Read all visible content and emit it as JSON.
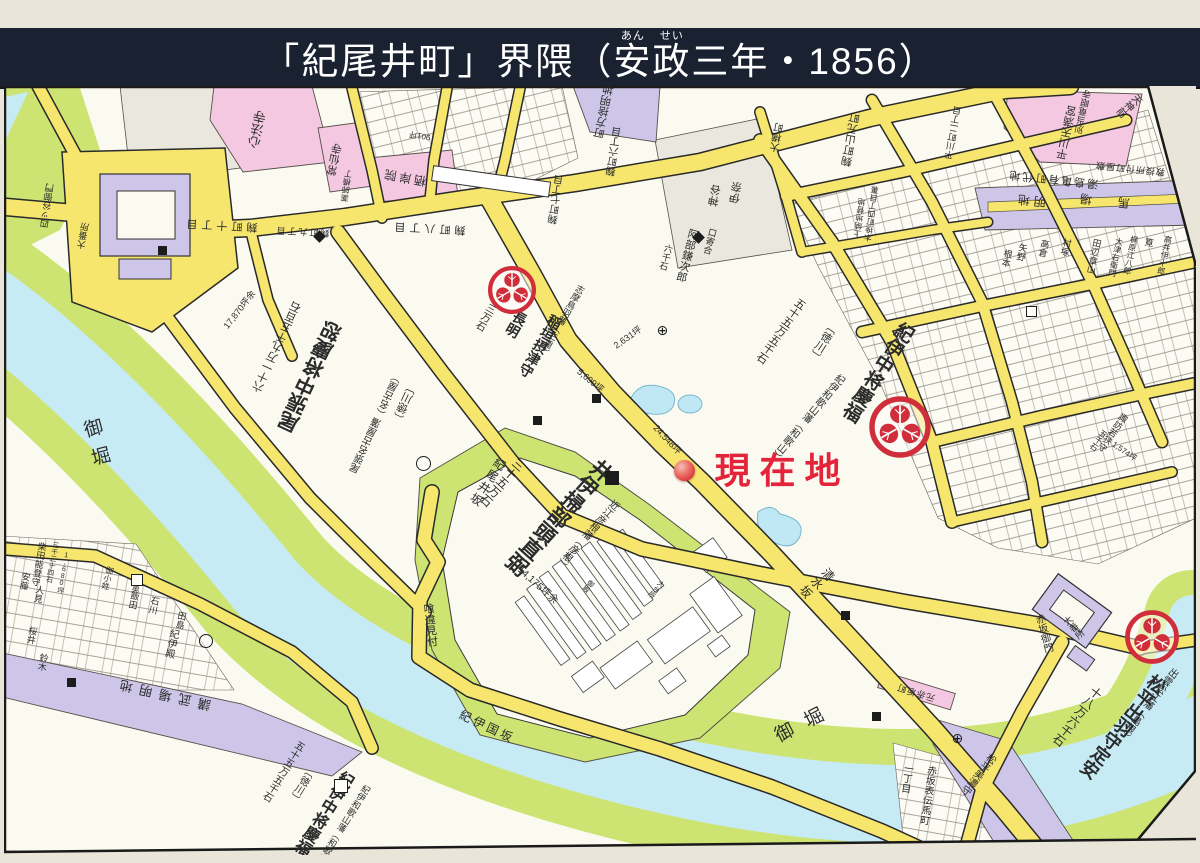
{
  "header": {
    "title_pre": "「紀尾井町」界隈（",
    "ruby": [
      {
        "base": "安",
        "rt": "あん"
      },
      {
        "base": "政",
        "rt": "せい"
      }
    ],
    "title_post": "三年・1856）"
  },
  "colors": {
    "header_bg": "#1a2130",
    "road_fill": "#f6e66e",
    "road_edge": "#2a2a2a",
    "water": "#c6ebf5",
    "bank_green": "#cde473",
    "temple_pink": "#f4c8e1",
    "open_purple": "#cdc6e9",
    "crest_red": "#cf2e3a",
    "marker_red": "#e3243b"
  },
  "map": {
    "current_location": {
      "label": "現在地",
      "dot_x": 684,
      "dot_y": 470
    },
    "labels": [
      {
        "t": "御堀",
        "x": 96,
        "y": 447,
        "s": 19,
        "v": 1,
        "r": -15,
        "ls": 10
      },
      {
        "t": "御堀",
        "x": 806,
        "y": 723,
        "s": 19,
        "r": -27,
        "ls": 14
      },
      {
        "t": "現在地",
        "x": 782,
        "y": 471,
        "s": 36,
        "w": 700,
        "c": "#e3243b",
        "ls": 9
      },
      {
        "t": "井伊掃部頭直弼",
        "x": 558,
        "y": 516,
        "s": 21,
        "v": 1,
        "r": 42,
        "w": 600
      },
      {
        "t": "近江彦根藩（彦根）",
        "x": 586,
        "y": 533,
        "s": 10,
        "v": 1,
        "r": 42
      },
      {
        "t": "三十五万石",
        "x": 502,
        "y": 482,
        "s": 12,
        "v": 1,
        "r": 42
      },
      {
        "t": "14,175坪余",
        "x": 537,
        "y": 586,
        "s": 10,
        "r": 42
      },
      {
        "t": "紀尾井坂",
        "x": 487,
        "y": 482,
        "s": 12,
        "v": 1,
        "r": 33,
        "ls": 2
      },
      {
        "t": "清水坂",
        "x": 816,
        "y": 583,
        "s": 12,
        "v": 1,
        "r": 52,
        "ls": 2
      },
      {
        "t": "喰違見付",
        "x": 429,
        "y": 625,
        "s": 11,
        "v": 1,
        "r": -6
      },
      {
        "t": "紀伊国坂",
        "x": 487,
        "y": 727,
        "s": 12,
        "r": 25,
        "ls": 3
      },
      {
        "t": "紀伊中将慶福",
        "x": 877,
        "y": 371,
        "s": 19,
        "v": 1,
        "r": 33,
        "w": 600
      },
      {
        "t": "紀伊和歌山藩（和歌山）",
        "x": 806,
        "y": 416,
        "s": 10,
        "v": 1,
        "r": 40
      },
      {
        "t": "〔徳川〕",
        "x": 822,
        "y": 341,
        "s": 11,
        "v": 1,
        "r": 33
      },
      {
        "t": "五十五万五千石",
        "x": 780,
        "y": 330,
        "s": 11,
        "v": 1,
        "r": 35
      },
      {
        "t": "尾張中将慶恕",
        "x": 312,
        "y": 378,
        "s": 20,
        "v": 1,
        "r": 205,
        "w": 600
      },
      {
        "t": "尾張名古屋藩（名古屋）",
        "x": 378,
        "y": 424,
        "s": 10,
        "v": 1,
        "r": 205
      },
      {
        "t": "〔徳川〕",
        "x": 406,
        "y": 404,
        "s": 11,
        "v": 1,
        "r": 205
      },
      {
        "t": "六十一万九千五百石",
        "x": 278,
        "y": 348,
        "s": 11,
        "v": 1,
        "r": 205
      },
      {
        "t": "17,870坪余",
        "x": 240,
        "y": 310,
        "s": 9,
        "r": -52
      },
      {
        "t": "稲垣摂津守",
        "x": 540,
        "y": 346,
        "s": 14,
        "v": 1,
        "r": 30,
        "w": 600
      },
      {
        "t": "長明",
        "x": 516,
        "y": 324,
        "s": 14,
        "v": 1,
        "r": 30,
        "w": 600
      },
      {
        "t": "志摩鳥羽藩（三重）",
        "x": 561,
        "y": 320,
        "s": 9,
        "v": 1,
        "r": 30
      },
      {
        "t": "三万石",
        "x": 484,
        "y": 316,
        "s": 10,
        "v": 1,
        "r": 30
      },
      {
        "t": "5,699坪",
        "x": 590,
        "y": 381,
        "s": 9,
        "r": 40
      },
      {
        "t": "2,631坪",
        "x": 628,
        "y": 338,
        "s": 9,
        "r": -35
      },
      {
        "t": "24,548坪",
        "x": 667,
        "y": 440,
        "s": 9,
        "r": 47
      },
      {
        "t": "口寄合",
        "x": 709,
        "y": 241,
        "s": 9,
        "v": 1,
        "r": 15
      },
      {
        "t": "阿部鎌次郎",
        "x": 686,
        "y": 255,
        "s": 11,
        "v": 1,
        "r": 15
      },
      {
        "t": "六千石",
        "x": 665,
        "y": 257,
        "s": 9,
        "v": 1,
        "r": 15
      },
      {
        "t": "松平出羽守定安",
        "x": 1122,
        "y": 726,
        "s": 18,
        "v": 1,
        "r": 38,
        "w": 600
      },
      {
        "t": "出雲松江藩（島根）",
        "x": 1147,
        "y": 703,
        "s": 10,
        "v": 1,
        "r": 38
      },
      {
        "t": "十八万六千石",
        "x": 1077,
        "y": 716,
        "s": 12,
        "v": 1,
        "r": 38
      },
      {
        "t": "赤坂御門",
        "x": 1042,
        "y": 634,
        "s": 10,
        "v": 1,
        "r": -15
      },
      {
        "t": "大番所",
        "x": 1073,
        "y": 628,
        "s": 9,
        "v": 1,
        "r": -40
      },
      {
        "t": "四ッ谷御門",
        "x": 48,
        "y": 206,
        "s": 9,
        "v": 1,
        "r": 188
      },
      {
        "t": "大番所",
        "x": 84,
        "y": 236,
        "s": 9,
        "v": 1,
        "r": 190
      },
      {
        "t": "講武場明地",
        "x": 162,
        "y": 694,
        "s": 13,
        "r": 193,
        "ls": 7
      },
      {
        "t": "紀伊殿",
        "x": 170,
        "y": 643,
        "s": 10,
        "v": 1,
        "r": 12
      },
      {
        "t": "石川",
        "x": 153,
        "y": 605,
        "s": 9,
        "v": 1,
        "r": 12
      },
      {
        "t": "飯田",
        "x": 133,
        "y": 600,
        "s": 9,
        "v": 1,
        "r": 12
      },
      {
        "t": "田島",
        "x": 180,
        "y": 620,
        "s": 9,
        "v": 1,
        "r": 12
      },
      {
        "t": "柴田能登守",
        "x": 38,
        "y": 564,
        "s": 9,
        "v": 1,
        "r": 10
      },
      {
        "t": "三千三十四石",
        "x": 52,
        "y": 562,
        "s": 7,
        "v": 1,
        "r": 10
      },
      {
        "t": "1,680坪",
        "x": 63,
        "y": 573,
        "s": 7,
        "v": 1,
        "r": 10
      },
      {
        "t": "安藤",
        "x": 24,
        "y": 581,
        "s": 9,
        "v": 1,
        "r": 10
      },
      {
        "t": "人見",
        "x": 38,
        "y": 594,
        "s": 9,
        "v": 1,
        "r": 10
      },
      {
        "t": "御小姓",
        "x": 107,
        "y": 578,
        "s": 8,
        "v": 1,
        "r": 14
      },
      {
        "t": "中奥",
        "x": 136,
        "y": 585,
        "s": 8,
        "v": 1,
        "r": 14
      },
      {
        "t": "桜井",
        "x": 31,
        "y": 635,
        "s": 9,
        "v": 1,
        "r": 10
      },
      {
        "t": "鈴木",
        "x": 42,
        "y": 662,
        "s": 9,
        "v": 1,
        "r": 10
      },
      {
        "t": "心法寺",
        "x": 258,
        "y": 130,
        "s": 13,
        "v": 1,
        "r": 192
      },
      {
        "t": "常仙寺",
        "x": 336,
        "y": 160,
        "s": 11,
        "v": 1,
        "r": 192
      },
      {
        "t": "栖岸院",
        "x": 404,
        "y": 177,
        "s": 12,
        "r": 190,
        "ls": 3
      },
      {
        "t": "薬師横丁",
        "x": 347,
        "y": 186,
        "s": 8,
        "v": 1,
        "r": 188
      },
      {
        "t": "麹町十丁目",
        "x": 220,
        "y": 224,
        "s": 11,
        "r": 183,
        "ls": 4
      },
      {
        "t": "麹町九丁目",
        "x": 302,
        "y": 231,
        "s": 9,
        "r": 183,
        "ls": 2
      },
      {
        "t": "麹町八丁目",
        "x": 428,
        "y": 227,
        "s": 11,
        "r": 183,
        "ls": 4
      },
      {
        "t": "麹町七丁目",
        "x": 558,
        "y": 200,
        "s": 10,
        "v": 1,
        "r": 188
      },
      {
        "t": "麹町六丁目",
        "x": 616,
        "y": 152,
        "s": 10,
        "v": 1,
        "r": 188
      },
      {
        "t": "大横町",
        "x": 779,
        "y": 138,
        "s": 10,
        "v": 1,
        "r": 190
      },
      {
        "t": "麹町山元町",
        "x": 852,
        "y": 140,
        "s": 11,
        "v": 1,
        "r": 190
      },
      {
        "t": "平川町二丁目",
        "x": 954,
        "y": 133,
        "s": 9,
        "v": 1,
        "r": 190
      },
      {
        "t": "木挽町四丁目裏",
        "x": 872,
        "y": 214,
        "s": 8,
        "v": 1,
        "r": 188
      },
      {
        "t": "上納地替地",
        "x": 860,
        "y": 218,
        "s": 8,
        "v": 1,
        "r": 188
      },
      {
        "t": "天神前",
        "x": 1128,
        "y": 104,
        "s": 10,
        "v": 1,
        "r": 50
      },
      {
        "t": "平川天満宮",
        "x": 1068,
        "y": 133,
        "s": 11,
        "v": 1,
        "r": 192
      },
      {
        "t": "別当竜眼寺",
        "x": 1084,
        "y": 112,
        "s": 9,
        "v": 1,
        "r": 192
      },
      {
        "t": "湯島亀有町代地",
        "x": 1053,
        "y": 178,
        "s": 11,
        "r": 186,
        "ls": 2
      },
      {
        "t": "教授所付町屋敷",
        "x": 1130,
        "y": 168,
        "s": 9,
        "r": 186,
        "ls": 1
      },
      {
        "t": "明地",
        "x": 1030,
        "y": 200,
        "s": 12,
        "r": 186,
        "ls": 4
      },
      {
        "t": "馬場",
        "x": 1092,
        "y": 199,
        "s": 12,
        "r": 186,
        "ls": 26
      },
      {
        "t": "町方捨明地",
        "x": 605,
        "y": 112,
        "s": 11,
        "v": 1,
        "r": 192
      },
      {
        "t": "神谷",
        "x": 716,
        "y": 196,
        "s": 11,
        "v": 1,
        "r": 190
      },
      {
        "t": "伊奈",
        "x": 737,
        "y": 193,
        "s": 11,
        "v": 1,
        "r": 190
      },
      {
        "t": "根本",
        "x": 1006,
        "y": 258,
        "s": 9,
        "v": 1,
        "r": 12
      },
      {
        "t": "矢野",
        "x": 1021,
        "y": 252,
        "s": 9,
        "v": 1,
        "r": 12
      },
      {
        "t": "高倉",
        "x": 1043,
        "y": 248,
        "s": 9,
        "v": 1,
        "r": 12
      },
      {
        "t": "村塚",
        "x": 1065,
        "y": 247,
        "s": 9,
        "v": 1,
        "r": 12
      },
      {
        "t": "田辺章山",
        "x": 1093,
        "y": 256,
        "s": 9,
        "v": 1,
        "r": 12
      },
      {
        "t": "大津右衛門",
        "x": 1115,
        "y": 257,
        "s": 8,
        "v": 1,
        "r": 12
      },
      {
        "t": "梶原江八郎",
        "x": 1130,
        "y": 255,
        "s": 8,
        "v": 1,
        "r": 12
      },
      {
        "t": "筧",
        "x": 1148,
        "y": 242,
        "s": 9,
        "v": 1,
        "r": 12
      },
      {
        "t": "高井伊十郎",
        "x": 1164,
        "y": 255,
        "s": 8,
        "v": 1,
        "r": 12
      },
      {
        "t": "諏訪若狭守",
        "x": 1112,
        "y": 432,
        "s": 9,
        "v": 1,
        "r": 35
      },
      {
        "t": "五千石",
        "x": 1098,
        "y": 440,
        "s": 8,
        "v": 1,
        "r": 35
      },
      {
        "t": "1,574坪",
        "x": 1124,
        "y": 452,
        "s": 8,
        "r": 35
      },
      {
        "t": "赤坂表伝馬町",
        "x": 926,
        "y": 795,
        "s": 10,
        "v": 1,
        "r": 8
      },
      {
        "t": "一丁目",
        "x": 905,
        "y": 778,
        "s": 10,
        "v": 1,
        "r": 8
      },
      {
        "t": "元赤坂町",
        "x": 916,
        "y": 692,
        "s": 9,
        "r": 197,
        "ls": 1
      },
      {
        "t": "松平美濃守",
        "x": 977,
        "y": 773,
        "s": 10,
        "v": 1,
        "r": 38
      },
      {
        "t": "901坪",
        "x": 420,
        "y": 135,
        "s": 8,
        "r": 190
      },
      {
        "t": "御殿",
        "x": 588,
        "y": 586,
        "s": 7,
        "v": 1,
        "r": 40
      },
      {
        "t": "大台所",
        "x": 656,
        "y": 589,
        "s": 7,
        "v": 1,
        "r": 40
      },
      {
        "t": "紀伊中将慶福",
        "x": 322,
        "y": 812,
        "s": 16,
        "v": 1,
        "r": 32,
        "w": 600
      },
      {
        "t": "〔徳川〕",
        "x": 300,
        "y": 784,
        "s": 10,
        "v": 1,
        "r": 32
      },
      {
        "t": "五十五万五千石",
        "x": 282,
        "y": 770,
        "s": 10,
        "v": 1,
        "r": 32
      },
      {
        "t": "紀伊和歌山藩（和歌山）",
        "x": 341,
        "y": 827,
        "s": 9,
        "v": 1,
        "r": 32
      }
    ],
    "markers": [
      {
        "type": "square",
        "x": 162,
        "y": 250,
        "d": 9
      },
      {
        "type": "square",
        "x": 596,
        "y": 398,
        "d": 9
      },
      {
        "type": "square",
        "x": 537,
        "y": 420,
        "d": 9
      },
      {
        "type": "square",
        "x": 612,
        "y": 478,
        "d": 14
      },
      {
        "type": "square",
        "x": 845,
        "y": 615,
        "d": 9
      },
      {
        "type": "square",
        "x": 876,
        "y": 716,
        "d": 9
      },
      {
        "type": "square",
        "x": 71,
        "y": 682,
        "d": 9
      },
      {
        "type": "diamond",
        "x": 319,
        "y": 236,
        "d": 9
      },
      {
        "type": "diamond",
        "x": 698,
        "y": 237,
        "d": 9
      },
      {
        "type": "circle",
        "x": 422,
        "y": 462,
        "d": 13
      },
      {
        "type": "circle",
        "x": 205,
        "y": 640,
        "d": 12
      },
      {
        "type": "box",
        "x": 340,
        "y": 785,
        "d": 12
      },
      {
        "type": "box",
        "x": 136,
        "y": 579,
        "d": 10
      },
      {
        "type": "box",
        "x": 1030,
        "y": 310,
        "d": 9
      },
      {
        "type": "cross",
        "x": 662,
        "y": 328,
        "d": 11,
        "glyph": "⊕"
      },
      {
        "type": "cross",
        "x": 957,
        "y": 736,
        "d": 11,
        "glyph": "⊕"
      }
    ],
    "crests": [
      {
        "name": "tokugawa-aoi-crest-kii",
        "x": 900,
        "y": 427,
        "d": 64
      },
      {
        "name": "matsudaira-crest-izumo",
        "x": 1152,
        "y": 637,
        "d": 56
      },
      {
        "name": "inagaki-crest-toba",
        "x": 512,
        "y": 290,
        "d": 50
      }
    ]
  }
}
